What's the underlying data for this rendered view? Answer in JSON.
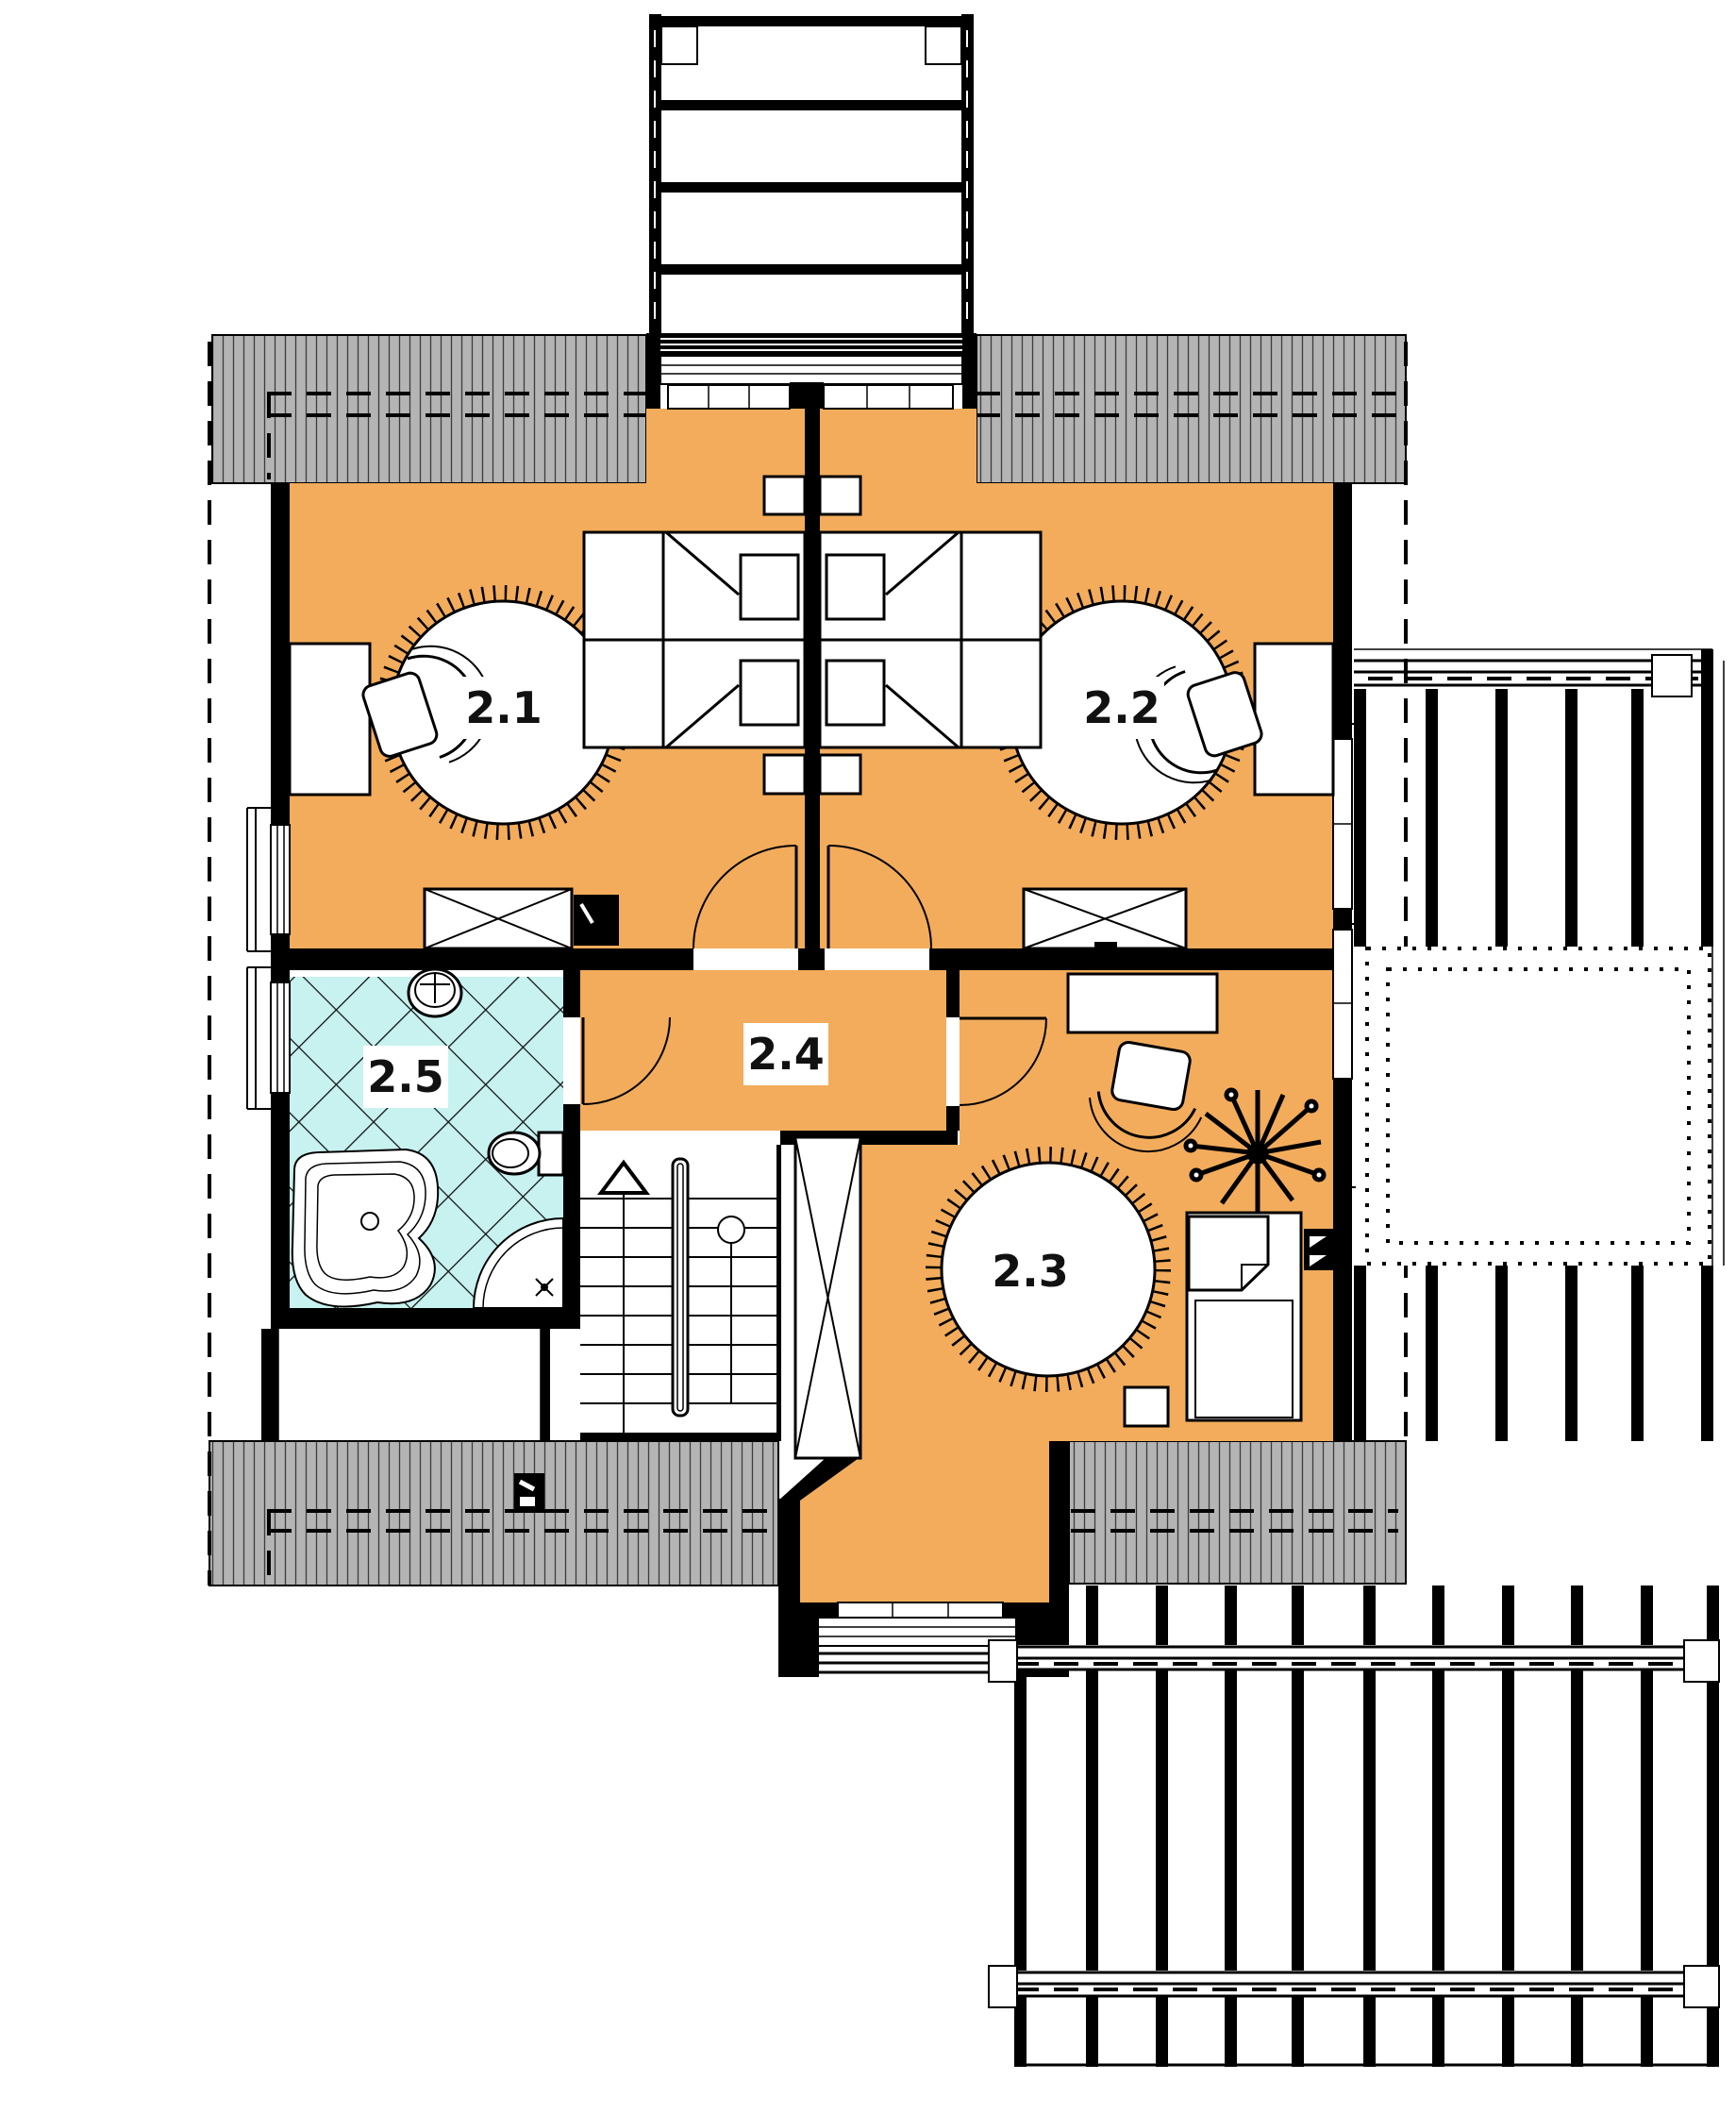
{
  "drawing": {
    "type": "architectural-floor-plan",
    "level": "attic storey",
    "orientation": "top-down"
  },
  "rooms": [
    {
      "id": "bedroom-1",
      "label": "2.1",
      "kind": "bedroom",
      "floor": "orange"
    },
    {
      "id": "bedroom-2",
      "label": "2.2",
      "kind": "bedroom",
      "floor": "orange"
    },
    {
      "id": "bedroom-3",
      "label": "2.3",
      "kind": "bedroom",
      "floor": "orange"
    },
    {
      "id": "hall",
      "label": "2.4",
      "kind": "hall-landing",
      "floor": "orange"
    },
    {
      "id": "bathroom",
      "label": "2.5",
      "kind": "bathroom",
      "floor": "cyan-tile"
    }
  ],
  "colors": {
    "floor_orange": "#F2AC5C",
    "tile_cyan": "#C7F2F0",
    "roof_gray": "#B4B4B4",
    "wall_black": "#000000",
    "furniture_white": "#FFFFFF"
  },
  "features": {
    "stairs": "U-return stair with central handrail, up arrow",
    "top_structure": "dormer balcony with railing",
    "bottom_structure": "dormer with balcony window",
    "right_structure": "pergola deck with skylight opening",
    "bottom_right_structure": "pergola deck beams",
    "bath_fixtures": [
      "corner-bathtub",
      "corner-shower",
      "washbasin",
      "toilet"
    ],
    "bedroom_fixtures": [
      "double-bed",
      "nightstands",
      "round-rug",
      "desk",
      "chair",
      "wardrobe",
      "tv"
    ],
    "room3_fixtures": [
      "single-bed",
      "desk",
      "chair",
      "plant",
      "round-rug",
      "stool",
      "tv"
    ],
    "roof_symbols": [
      "roof-window"
    ]
  }
}
